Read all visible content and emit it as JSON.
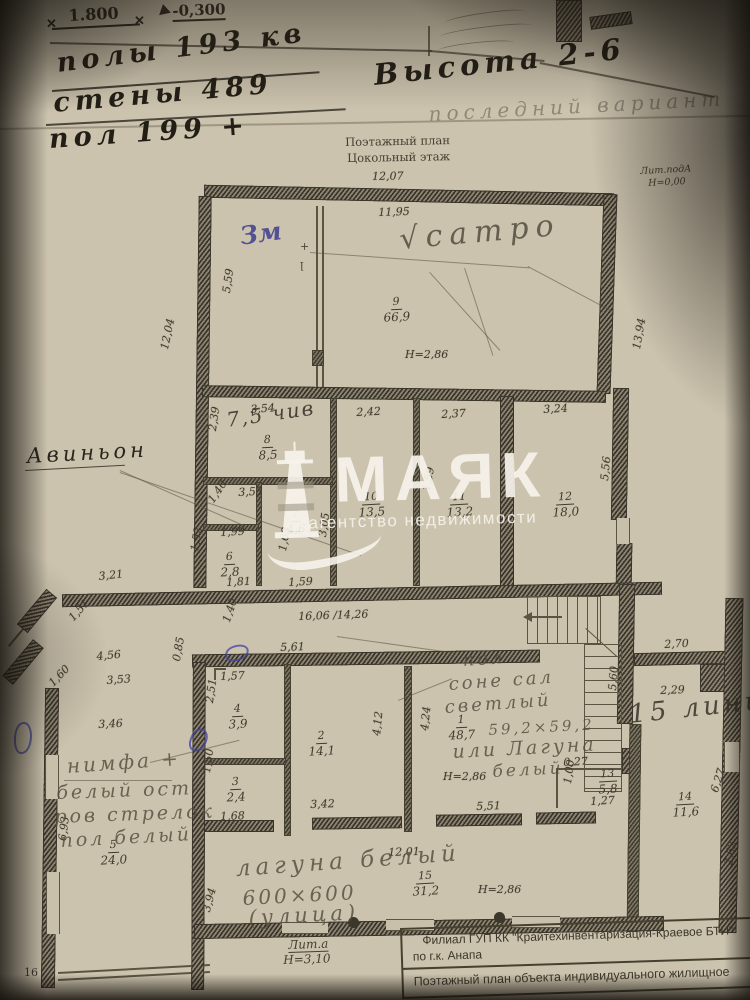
{
  "meta": {
    "page_number": "16"
  },
  "top_annotations": {
    "dim_mark": "1.800",
    "elev_mark": "-0,300",
    "faint_height": "Н=4,60",
    "marker_lines": [
      "полы 193 кв",
      "стены 489",
      "пол 199 +"
    ],
    "height_note": "Высота 2-6",
    "pencil_note": "последний вариант"
  },
  "plan_header": {
    "title_line1": "Поэтажный план",
    "title_line2": "Цокольный этаж",
    "lit_pod_line1": "Лит.подА",
    "lit_pod_line2": "Н=0,00"
  },
  "watermark": {
    "brand": "МАЯК",
    "tagline": "агентство недвижимости"
  },
  "handwritten": {
    "avignon": "Авиньон",
    "zm": "Зм",
    "satro": "√сатро",
    "room8_note": "7,5 чив",
    "room1_note_lines": [
      "пол",
      "соне сал",
      "светлый",
      "59,2×59,2",
      "или Лагуна",
      "белый"
    ],
    "room5_note_lines": [
      "нимфа +",
      "белый ост-",
      "ров стрелок",
      "пол белый"
    ],
    "room15_note_lines": [
      "лагуна белый",
      "600×600",
      "(улица)"
    ],
    "right_wing_note": "15 линия"
  },
  "footer": {
    "lit_a": "Лит.а",
    "lit_a_h": "Н=3,10",
    "stamp_line1": "Филиал ГУП КК \"Крайтехинвентаризация-Краевое БТИ\"",
    "stamp_line2": "по г.к. Анапа",
    "stamp_line3": "Поэтажный план объекта индивидуального жилищное"
  },
  "rooms": [
    {
      "n": "9",
      "a": "66,9",
      "x": 383,
      "y": 290
    },
    {
      "n": "8",
      "a": "8,5",
      "x": 258,
      "y": 428
    },
    {
      "n": "7",
      "a": "4,6",
      "x": 286,
      "y": 502
    },
    {
      "n": "10",
      "a": "13,5",
      "x": 358,
      "y": 485
    },
    {
      "n": "11",
      "a": "13,2",
      "x": 446,
      "y": 485
    },
    {
      "n": "12",
      "a": "18,0",
      "x": 552,
      "y": 485
    },
    {
      "n": "6",
      "a": "2,8",
      "x": 220,
      "y": 545
    },
    {
      "n": "4",
      "a": "3,9",
      "x": 228,
      "y": 697
    },
    {
      "n": "3",
      "a": "2,4",
      "x": 226,
      "y": 770
    },
    {
      "n": "2",
      "a": "14,1",
      "x": 308,
      "y": 724
    },
    {
      "n": "1",
      "a": "48,7",
      "x": 448,
      "y": 708
    },
    {
      "n": "5",
      "a": "24,0",
      "x": 100,
      "y": 833
    },
    {
      "n": "13",
      "a": "5,8",
      "x": 598,
      "y": 762
    },
    {
      "n": "14",
      "a": "11,6",
      "x": 672,
      "y": 785
    },
    {
      "n": "15",
      "a": "31,2",
      "x": 412,
      "y": 864
    }
  ],
  "heights": [
    {
      "t": "Н=2,86",
      "x": 405,
      "y": 348
    },
    {
      "t": "Н=2,86",
      "x": 443,
      "y": 770
    },
    {
      "t": "Н=2,86",
      "x": 478,
      "y": 883
    }
  ],
  "dims": [
    {
      "t": "12,07",
      "x": 372,
      "y": 170,
      "r": -1
    },
    {
      "t": "11,95",
      "x": 378,
      "y": 206,
      "r": -2
    },
    {
      "t": "12,04",
      "x": 158,
      "y": 348,
      "r": -78
    },
    {
      "t": "13,94",
      "x": 630,
      "y": 348,
      "r": -80
    },
    {
      "t": "5,59",
      "x": 220,
      "y": 292,
      "r": -82
    },
    {
      "t": "3,54",
      "x": 250,
      "y": 403,
      "r": -4
    },
    {
      "t": "2,39",
      "x": 206,
      "y": 430,
      "r": -82
    },
    {
      "t": "2,42",
      "x": 356,
      "y": 406,
      "r": -3
    },
    {
      "t": "2,37",
      "x": 441,
      "y": 408,
      "r": -3
    },
    {
      "t": "3,24",
      "x": 543,
      "y": 403,
      "r": -3
    },
    {
      "t": "5,56",
      "x": 598,
      "y": 480,
      "r": -84
    },
    {
      "t": "3,53",
      "x": 238,
      "y": 486,
      "r": -3
    },
    {
      "t": "1,40",
      "x": 205,
      "y": 498,
      "r": -55
    },
    {
      "t": "1,99",
      "x": 220,
      "y": 526,
      "r": -3
    },
    {
      "t": "1,52",
      "x": 188,
      "y": 550,
      "r": -80
    },
    {
      "t": "1,81",
      "x": 226,
      "y": 576,
      "r": -3
    },
    {
      "t": "1,63",
      "x": 276,
      "y": 550,
      "r": -80
    },
    {
      "t": "3,05",
      "x": 316,
      "y": 536,
      "r": -82
    },
    {
      "t": "1,59",
      "x": 288,
      "y": 576,
      "r": -3
    },
    {
      "t": "1,59",
      "x": 420,
      "y": 490,
      "r": -80
    },
    {
      "t": "3,21",
      "x": 98,
      "y": 570,
      "r": -6
    },
    {
      "t": "16,06 /14,26",
      "x": 298,
      "y": 610,
      "r": -2
    },
    {
      "t": "1,40",
      "x": 220,
      "y": 620,
      "r": -72
    },
    {
      "t": "5,61",
      "x": 280,
      "y": 641,
      "r": -2
    },
    {
      "t": "1,57",
      "x": 220,
      "y": 670,
      "r": -2
    },
    {
      "t": "0,85",
      "x": 170,
      "y": 660,
      "r": -80
    },
    {
      "t": "4,56",
      "x": 96,
      "y": 650,
      "r": -5
    },
    {
      "t": "1,51",
      "x": 66,
      "y": 615,
      "r": -48
    },
    {
      "t": "1,60",
      "x": 46,
      "y": 680,
      "r": -46
    },
    {
      "t": "3,53",
      "x": 106,
      "y": 674,
      "r": -4
    },
    {
      "t": "3,46",
      "x": 98,
      "y": 718,
      "r": -3
    },
    {
      "t": "2,51",
      "x": 203,
      "y": 702,
      "r": -82
    },
    {
      "t": "1,50",
      "x": 200,
      "y": 772,
      "r": -82
    },
    {
      "t": "1,68",
      "x": 220,
      "y": 810,
      "r": -2
    },
    {
      "t": "3,42",
      "x": 310,
      "y": 798,
      "r": -2
    },
    {
      "t": "4,12",
      "x": 370,
      "y": 735,
      "r": -84
    },
    {
      "t": "4,24",
      "x": 418,
      "y": 730,
      "r": -84
    },
    {
      "t": "5,51",
      "x": 476,
      "y": 800,
      "r": -2
    },
    {
      "t": "12,01",
      "x": 388,
      "y": 846,
      "r": -2
    },
    {
      "t": "3,94",
      "x": 200,
      "y": 910,
      "r": -75
    },
    {
      "t": "6,93",
      "x": 56,
      "y": 840,
      "r": -83
    },
    {
      "t": "0,27",
      "x": 563,
      "y": 756,
      "r": -3
    },
    {
      "t": "1,00",
      "x": 561,
      "y": 783,
      "r": -82
    },
    {
      "t": "1,27",
      "x": 590,
      "y": 795,
      "r": -3
    },
    {
      "t": "5,60",
      "x": 606,
      "y": 690,
      "r": -86
    },
    {
      "t": "2,70",
      "x": 664,
      "y": 638,
      "r": -3
    },
    {
      "t": "2,29",
      "x": 660,
      "y": 684,
      "r": -2
    },
    {
      "t": "6,27",
      "x": 708,
      "y": 790,
      "r": -72
    },
    {
      "t": "2,62",
      "x": 722,
      "y": 864,
      "r": -80
    }
  ]
}
